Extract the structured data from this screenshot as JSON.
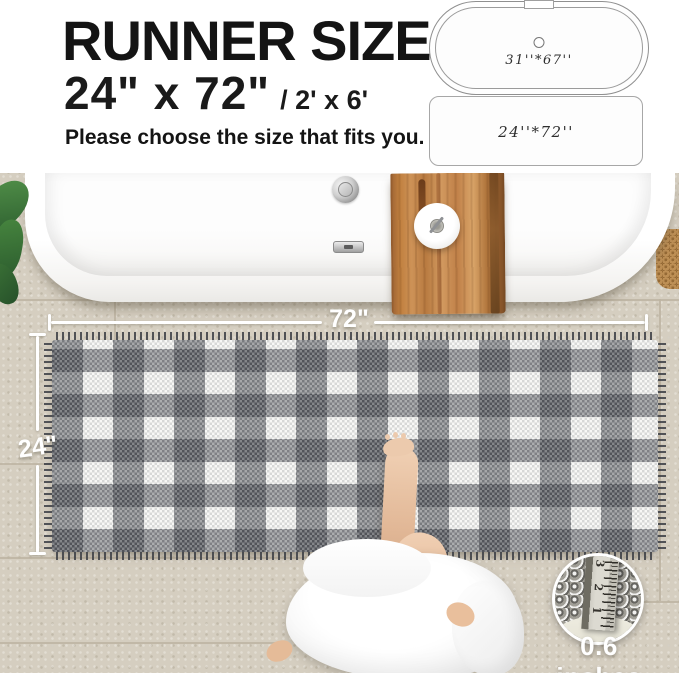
{
  "header": {
    "title": "RUNNER SIZE",
    "size_main": "24\"  x 72\"",
    "size_sub": "/ 2' x 6'",
    "subtitle": "Please choose the size that fits you."
  },
  "diagrams": {
    "bathtub": {
      "label": "31''*67''"
    },
    "runner": {
      "label": "24''*72''"
    }
  },
  "photo_overlay": {
    "width_label": "72\"",
    "height_label": "24\"",
    "inset": {
      "caption": "0.6 inches",
      "ruler_numbers": [
        "3",
        "2",
        "1"
      ]
    }
  },
  "colors": {
    "text": "#141414",
    "tile": "#d5cec0",
    "wood": "#c08048",
    "plaid_dark": "#2a2d34",
    "rug_base": "#f5f5f3",
    "dimension_line": "#ffffff",
    "plant_green": "#2e6030"
  }
}
